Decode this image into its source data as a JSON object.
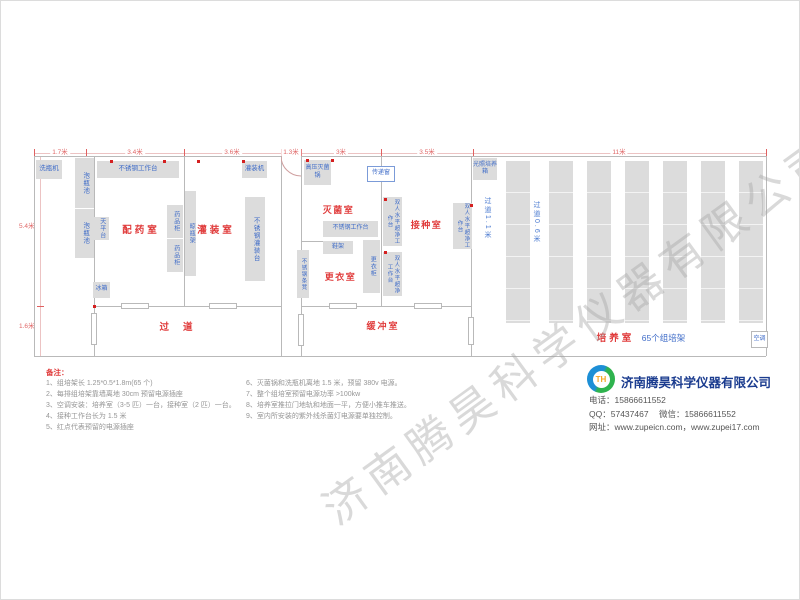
{
  "plan": {
    "dims_top": [
      "1.7米",
      "3.4米",
      "3.6米",
      "1.3米",
      "3米",
      "3.5米",
      "11米"
    ],
    "dims_left": [
      "5.4米",
      "1.6米"
    ],
    "rooms": {
      "prep": "配药室",
      "filling": "灌装室",
      "sterilize": "灭菌室",
      "changing": "更衣室",
      "inoculation": "接种室",
      "corridor": "过道",
      "buffer": "缓冲室",
      "culture": "培养室",
      "culture_sub": "65个组培架"
    },
    "corridors": {
      "c11": "过道1.1米",
      "c06": "过道0.6米"
    },
    "equipment": {
      "bottle_washer": "洗瓶机",
      "soak_pool": "泡瓶池",
      "ss_worktable": "不锈钢工作台",
      "balance_table": "天平台",
      "medicine_cabinet": "药品柜",
      "bottle_rack": "晾瓶架",
      "fridge": "冰箱",
      "filling_machine": "灌装机",
      "ss_filling_table": "不锈钢灌装台",
      "autoclave": "高压灭菌锅",
      "transfer_window": "传递窗",
      "shoe_rack": "鞋架",
      "ss_bench": "不锈钢条凳",
      "locker": "更衣柜",
      "clean_bench": "双人水平超净工作台",
      "light_incubator": "光照培养箱",
      "air_conditioner": "空调"
    }
  },
  "notes": {
    "heading": "备注：",
    "left": [
      "1、组培架长 1.25*0.5*1.8m(65 个)",
      "2、每排组培架靠墙离地 30cm 预留电源插座",
      "3、空调安装：培养室（3-5 匹）一台，接种室（2 匹）一台。",
      "4、接种工作台长为 1.5 米",
      "5、红点代表预留的电源插座"
    ],
    "right": [
      "6、灭菌锅和洗瓶机离地 1.5 米，预留 380v 电源。",
      "7、整个组培室预留电源功率 >100kw",
      "8、培养室推拉门地轨和地面一平，方便小推车推送。",
      "9、室内所安装的紫外线杀菌灯电源要单独控制。"
    ]
  },
  "company": {
    "name": "济南腾昊科学仪器有限公司",
    "logo_text": "TH",
    "phone_label": "电话：",
    "phone": "15866611552",
    "qq_label": "QQ：",
    "qq": "57437467",
    "wechat_label": "微信：",
    "wechat": "15866611552",
    "web_label": "网址：",
    "websites": "www.zupeicn.com，www.zupei17.com"
  },
  "watermark": "济南腾昊科学仪器有限公司",
  "colors": {
    "room_label": "#e03b3b",
    "equipment_label": "#3f6cc8",
    "dimension": "#e06868",
    "wall": "#b9b9b9",
    "furniture_fill": "#dcdcdc",
    "outlet_dot": "#d42020",
    "company_name": "#1b3c8f"
  }
}
